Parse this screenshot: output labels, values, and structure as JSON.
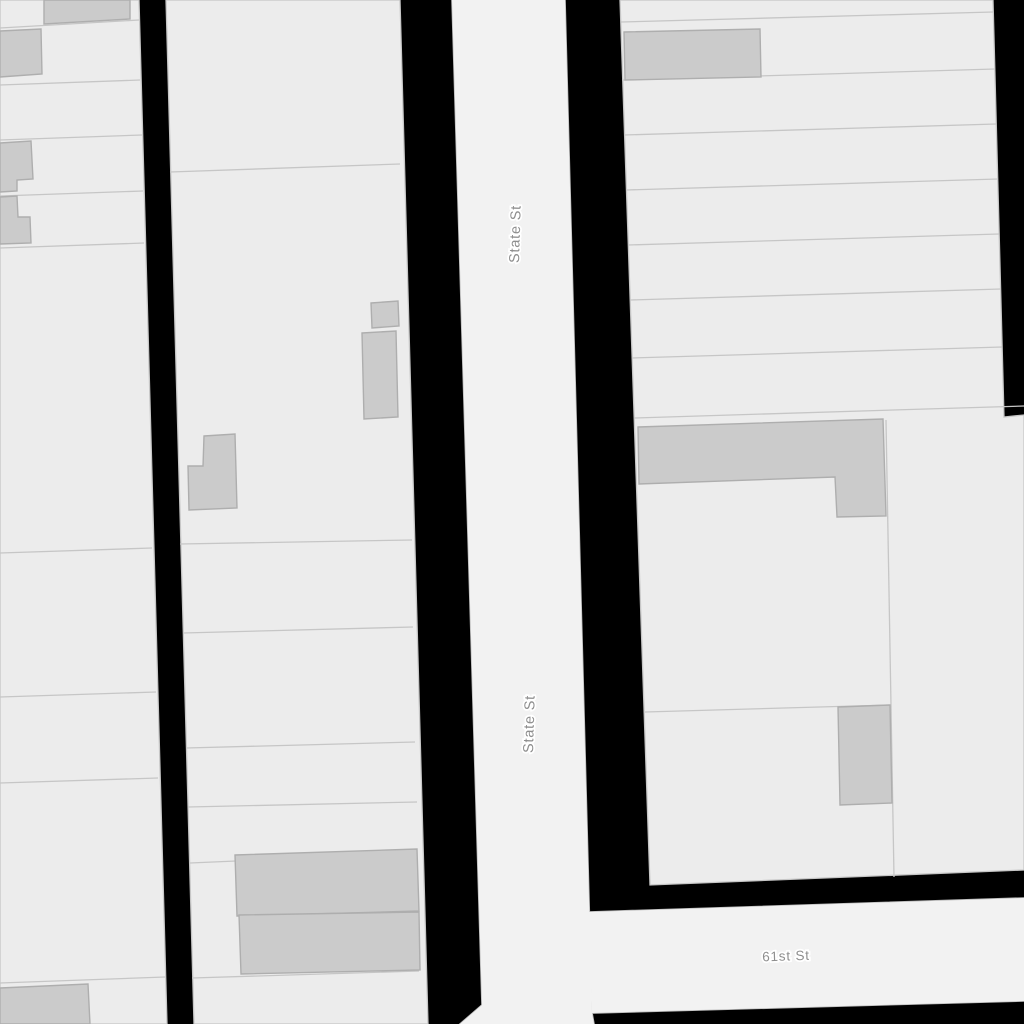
{
  "map": {
    "type": "street-map-tile",
    "roads": [
      {
        "name": "State St",
        "orientation": "vertical"
      },
      {
        "name": "61st St",
        "orientation": "horizontal"
      }
    ],
    "labels": {
      "state_st_upper": "State St",
      "state_st_lower": "State St",
      "sixty_first_st": "61st St"
    },
    "features": {
      "parcel_blocks": 3,
      "buildings": 13
    },
    "colors": {
      "background": "#000000",
      "parcel": "#ececec",
      "road": "#f2f2f2",
      "parcel_line": "#c6c6c6",
      "road_casing": "#bcbcbc",
      "building": "#cbcbcb",
      "building_border": "#aeaeae",
      "label": "#8e8e8e",
      "label_halo": "#ffffff"
    }
  }
}
